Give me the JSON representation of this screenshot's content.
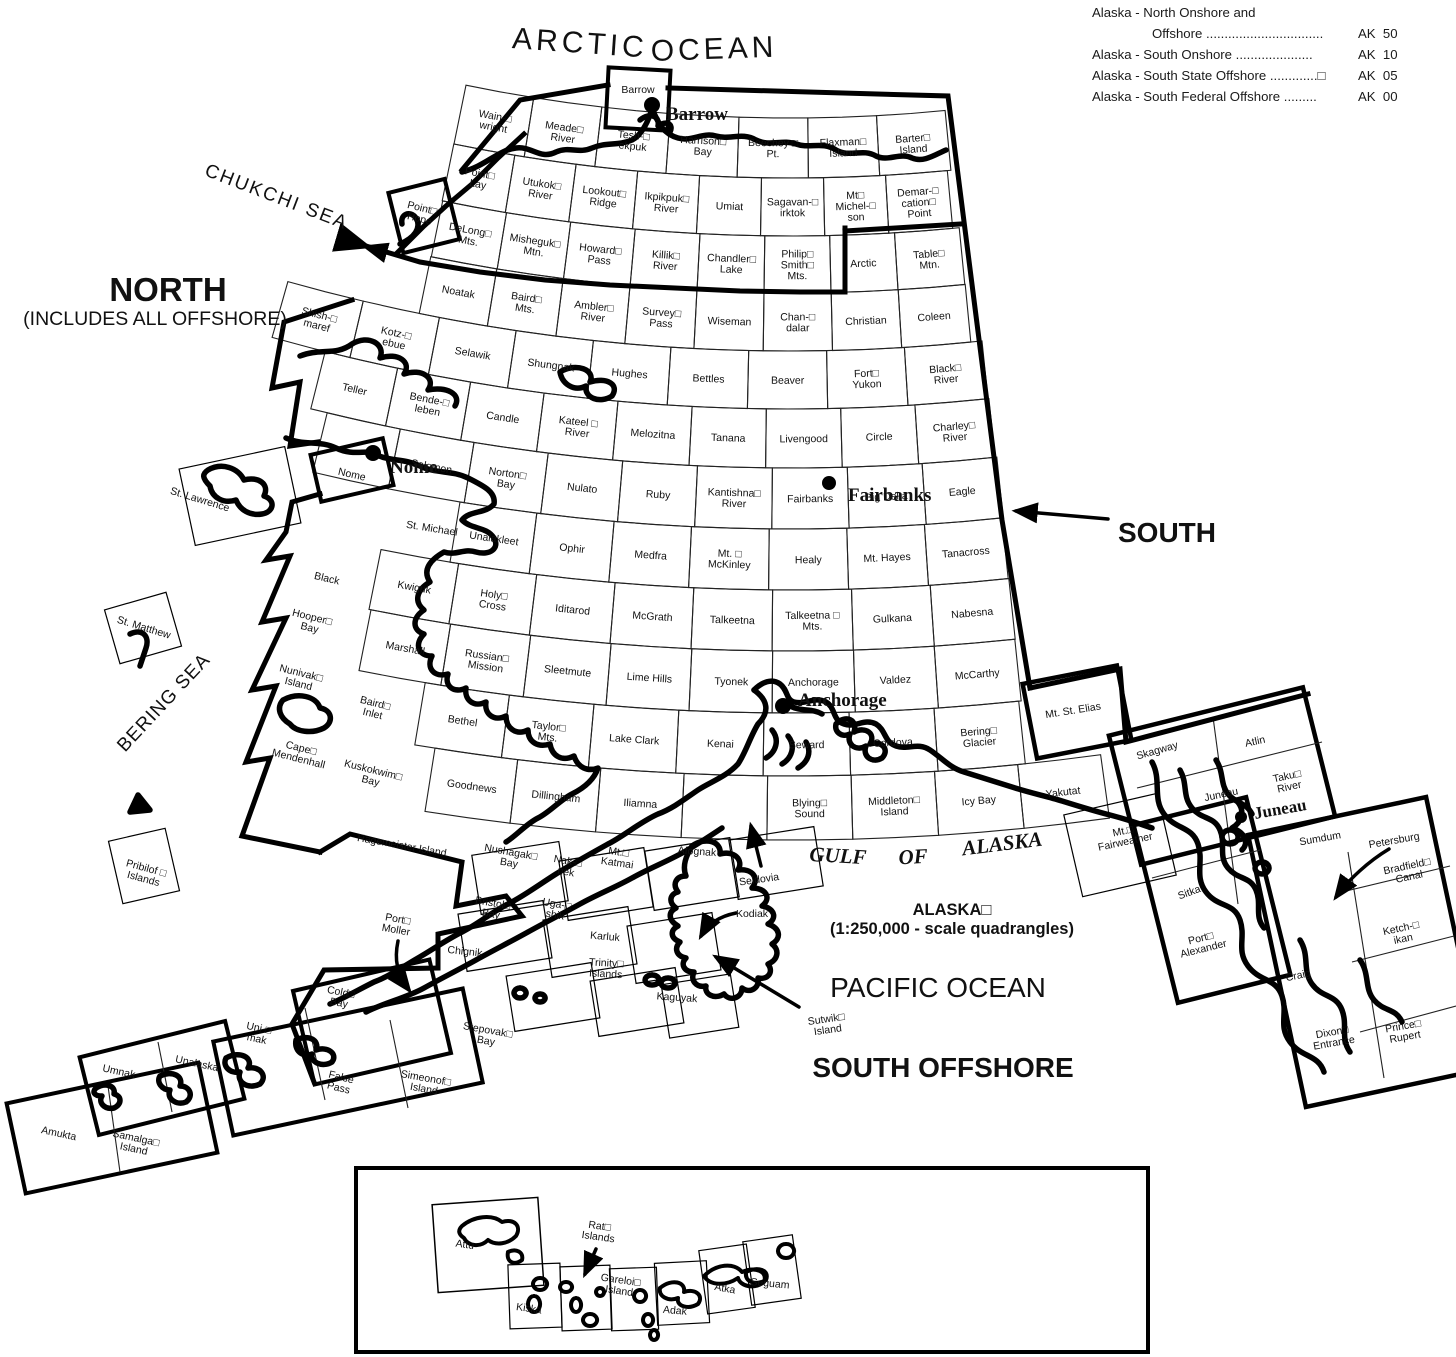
{
  "legend": {
    "items": [
      {
        "line1": "Alaska - North Onshore and",
        "line2": "Offshore ................................",
        "code": "AK  50"
      },
      {
        "line1": "Alaska - South Onshore .....................",
        "code": "AK  10"
      },
      {
        "line1": "Alaska - South State Offshore .............□",
        "code": "AK  05"
      },
      {
        "line1": "Alaska - South Federal Offshore .........",
        "code": "AK  00"
      }
    ]
  },
  "sea_labels": [
    {
      "t": "ARCTIC",
      "x": 580,
      "y": 42,
      "s": 30,
      "sp": 4,
      "r": 4
    },
    {
      "t": "OCEAN",
      "x": 714,
      "y": 48,
      "s": 30,
      "sp": 4,
      "r": -2
    },
    {
      "t": "CHUKCHI SEA",
      "x": 277,
      "y": 196,
      "s": 19,
      "sp": 2,
      "r": 21
    },
    {
      "t": "NORTH",
      "x": 168,
      "y": 289,
      "s": 33,
      "b": 1
    },
    {
      "t": "(INCLUDES ALL OFFSHORE)",
      "x": 155,
      "y": 318,
      "s": 19.5
    },
    {
      "t": "BERING SEA",
      "x": 163,
      "y": 702,
      "s": 19,
      "sp": 1,
      "r": -47
    },
    {
      "t": "SOUTH",
      "x": 1167,
      "y": 532,
      "s": 28,
      "b": 1
    },
    {
      "t": "GULF",
      "x": 838,
      "y": 855,
      "s": 21,
      "b": 1,
      "it": 1,
      "serif": 1,
      "r": 3
    },
    {
      "t": "OF",
      "x": 913,
      "y": 856,
      "s": 21,
      "b": 1,
      "it": 1,
      "serif": 1,
      "r": -3
    },
    {
      "t": "ALASKA",
      "x": 1002,
      "y": 843,
      "s": 21,
      "b": 1,
      "it": 1,
      "serif": 1,
      "r": -7
    },
    {
      "t": "ALASKA□",
      "x": 952,
      "y": 909,
      "s": 16.5,
      "b": 1
    },
    {
      "t": "(1:250,000 - scale quadrangles)",
      "x": 952,
      "y": 928,
      "s": 16.5,
      "b": 1
    },
    {
      "t": "PACIFIC OCEAN",
      "x": 938,
      "y": 987,
      "s": 28
    },
    {
      "t": "SOUTH OFFSHORE",
      "x": 943,
      "y": 1067,
      "s": 28,
      "b": 1
    }
  ],
  "cities": [
    {
      "n": "Barrow",
      "x": 666,
      "y": 113,
      "dx": 652,
      "dy": 105,
      "dr": 8,
      "r": 0,
      "s": 19
    },
    {
      "n": "Nome",
      "x": 390,
      "y": 466,
      "dx": 373,
      "dy": 453,
      "dr": 8,
      "r": 0,
      "s": 19
    },
    {
      "n": "Fairbanks",
      "x": 848,
      "y": 494,
      "dx": 829,
      "dy": 483,
      "dr": 7,
      "r": 0,
      "s": 19
    },
    {
      "n": "Anchorage",
      "x": 798,
      "y": 699,
      "dx": 783,
      "dy": 706,
      "dr": 8,
      "r": 0,
      "s": 19
    },
    {
      "n": "Juneau",
      "x": 1254,
      "y": 813,
      "dx": 1241,
      "dy": 817,
      "dr": 6,
      "r": -10,
      "s": 17
    }
  ],
  "fan_rows": [
    {
      "y0": 118,
      "y1": 178,
      "wx": 460,
      "ex": 948,
      "c": [
        "Wain-□\nwright",
        "Meade□\nRiver",
        "Tesh-□\nekpuk",
        "Harrison□\nBay",
        "Beechey □\nPt.",
        "Flaxman□\nIsland",
        "Barter□\nIsland"
      ]
    },
    {
      "y0": 178,
      "y1": 236,
      "wx": 448,
      "ex": 950,
      "c": [
        "Point□\nLay",
        "Utukok□\nRiver",
        "Lookout□\nRidge",
        "Ikpikpuk□\nRiver",
        "Umiat",
        "Sagavan-□\nirktok",
        "Mt□\nMichel-□\nson",
        "Demar-□\ncation□\nPoint"
      ]
    },
    {
      "y0": 236,
      "y1": 293,
      "wx": 437,
      "ex": 962,
      "c": [
        "DeLong□\nMts.",
        "Misheguk□\nMtn.",
        "Howard□\nPass",
        "Killik□\nRiver",
        "Chandler□\nLake",
        "Philip□\nSmith□\nMts.",
        "Arctic",
        "Table□\nMtn."
      ]
    },
    {
      "y0": 293,
      "y1": 351,
      "wx": 425,
      "ex": 968,
      "c": [
        "Noatak",
        "Baird□\nMts.",
        "Ambler□\nRiver",
        "Survey□\nPass",
        "Wiseman",
        "Chan-□\ndalar",
        "Christian",
        "Coleen"
      ]
    },
    {
      "y0": 351,
      "y1": 409,
      "wx": 280,
      "ex": 985,
      "c": [
        "Shish-□\nmaref",
        "Kotz-□\nebue",
        "Selawik",
        "Shungnak",
        "Hughes",
        "Bettles",
        "Beaver",
        "Fort□\nYukon",
        "Black□\nRiver"
      ]
    },
    {
      "y0": 409,
      "y1": 468,
      "wx": 318,
      "ex": 992,
      "c": [
        "Teller",
        "Bende-□\nleben",
        "Candle",
        "Kateel □\nRiver",
        "Melozitna",
        "Tanana",
        "Livengood",
        "Circle",
        "Charley□\nRiver"
      ]
    },
    {
      "y0": 468,
      "y1": 529,
      "wx": 320,
      "ex": 1000,
      "c": [
        "",
        "Solomon",
        "Norton□\nBay",
        "Nulato",
        "Ruby",
        "Kantishna□\nRiver",
        "Fairbanks",
        "Big Delta",
        "Eagle"
      ]
    },
    {
      "y0": 529,
      "y1": 590,
      "wx": 455,
      "ex": 1005,
      "c": [
        "Unalakleet",
        "Ophir",
        "Medfra",
        "Mt. □\nMcKinley",
        "Healy",
        "Mt. Hayes",
        "Tanacross"
      ]
    },
    {
      "y0": 590,
      "y1": 651,
      "wx": 375,
      "ex": 1012,
      "c": [
        "Kwiguk",
        "Holy□\nCross",
        "Iditarod",
        "McGrath",
        "Talkeetna",
        "Talkeetna □\nMts.",
        "Gulkana",
        "Nabesna"
      ]
    },
    {
      "y0": 651,
      "y1": 713,
      "wx": 365,
      "ex": 1018,
      "c": [
        "Marshall",
        "Russian□\nMission",
        "Sleetmute",
        "Lime Hills",
        "Tyonek",
        "Anchorage",
        "Valdez",
        "McCarthy"
      ]
    },
    {
      "y0": 713,
      "y1": 776,
      "wx": 420,
      "ex": 1022,
      "c": [
        "Bethel",
        "Taylor□\nMts.",
        "Lake Clark",
        "Kenai",
        "Seward",
        "Cordova",
        "Bering□\nGlacier"
      ]
    },
    {
      "y0": 776,
      "y1": 840,
      "wx": 430,
      "ex": 1105,
      "c": [
        "Goodnews",
        "Dillingham",
        "Iliamna",
        "",
        "Blying□\nSound",
        "Middleton□\nIsland",
        "Icy Bay",
        "Yakutat"
      ]
    }
  ],
  "labels": [
    {
      "t": "Point□\nHope",
      "x": 421,
      "y": 213,
      "r": 14
    },
    {
      "t": "Barrow",
      "x": 638,
      "y": 89,
      "r": 0
    },
    {
      "t": "Nome",
      "x": 352,
      "y": 474,
      "r": 13
    },
    {
      "t": "St. Michael",
      "x": 432,
      "y": 528,
      "r": 9
    },
    {
      "t": "Black",
      "x": 327,
      "y": 578,
      "r": 13
    },
    {
      "t": "Hooper□\nBay",
      "x": 311,
      "y": 622,
      "r": 14
    },
    {
      "t": "Nunivak□\nIsland",
      "x": 300,
      "y": 678,
      "r": 14
    },
    {
      "t": "Baird□\nInlet",
      "x": 374,
      "y": 708,
      "r": 14
    },
    {
      "t": "Cape□\nMendenhall",
      "x": 300,
      "y": 753,
      "r": 14
    },
    {
      "t": "Kuskokwim□\nBay",
      "x": 372,
      "y": 775,
      "r": 14
    },
    {
      "t": "Hagemeister Island",
      "x": 402,
      "y": 845,
      "r": 10
    },
    {
      "t": "Nushagak□\nBay",
      "x": 510,
      "y": 857,
      "r": 10
    },
    {
      "t": "Nak-□\nnek",
      "x": 567,
      "y": 866,
      "r": 10
    },
    {
      "t": "Mt.□\nKatmai",
      "x": 618,
      "y": 857,
      "r": 8
    },
    {
      "t": "Afognak",
      "x": 697,
      "y": 851,
      "r": 4
    },
    {
      "t": "Bristol□\nBay",
      "x": 492,
      "y": 908,
      "r": 10
    },
    {
      "t": "Uga-□\nshik",
      "x": 556,
      "y": 909,
      "r": 10
    },
    {
      "t": "Karluk",
      "x": 605,
      "y": 936,
      "r": 5
    },
    {
      "t": "Trinity□\nIslands",
      "x": 606,
      "y": 968,
      "r": 3
    },
    {
      "t": "Kaguyak",
      "x": 677,
      "y": 997,
      "r": 4
    },
    {
      "t": "Seldovia",
      "x": 759,
      "y": 879,
      "r": -8
    },
    {
      "t": "Kodiak",
      "x": 752,
      "y": 913,
      "r": 0
    },
    {
      "t": "Port□\nMoller",
      "x": 397,
      "y": 924,
      "r": 10
    },
    {
      "t": "Chignik",
      "x": 465,
      "y": 951,
      "r": 6
    },
    {
      "t": "Stepovak□\nBay",
      "x": 487,
      "y": 1035,
      "r": 10
    },
    {
      "t": "Sutwik□\nIsland",
      "x": 827,
      "y": 1024,
      "r": -8
    },
    {
      "t": "Cold□\nBay",
      "x": 340,
      "y": 997,
      "r": 11
    },
    {
      "t": "Uni-□\nmak",
      "x": 258,
      "y": 1033,
      "r": 12
    },
    {
      "t": "False\nPass",
      "x": 340,
      "y": 1082,
      "r": 14
    },
    {
      "t": "Simeonof□\nIsland",
      "x": 425,
      "y": 1083,
      "r": 10
    },
    {
      "t": "Umnak",
      "x": 119,
      "y": 1071,
      "r": 12
    },
    {
      "t": "Unalaska",
      "x": 197,
      "y": 1063,
      "r": 12
    },
    {
      "t": "Amukta",
      "x": 59,
      "y": 1133,
      "r": 12
    },
    {
      "t": "Samalga□\nIsland",
      "x": 135,
      "y": 1143,
      "r": 12
    },
    {
      "t": "St. Lawrence",
      "x": 200,
      "y": 499,
      "r": 17
    },
    {
      "t": "St. Matthew",
      "x": 144,
      "y": 627,
      "r": 17
    },
    {
      "t": "Pribilof □\nIslands",
      "x": 145,
      "y": 873,
      "r": 15
    },
    {
      "t": "Mt. St. Elias",
      "x": 1073,
      "y": 710,
      "r": -9
    },
    {
      "t": "Mt.□\nFairweather",
      "x": 1124,
      "y": 836,
      "r": -12
    },
    {
      "t": "Skagway",
      "x": 1157,
      "y": 750,
      "r": -16
    },
    {
      "t": "Atlin",
      "x": 1255,
      "y": 741,
      "r": -12
    },
    {
      "t": "Juneau",
      "x": 1221,
      "y": 794,
      "r": -12
    },
    {
      "t": "Taku□\nRiver",
      "x": 1288,
      "y": 781,
      "r": -12
    },
    {
      "t": "Sumdum",
      "x": 1320,
      "y": 838,
      "r": -10
    },
    {
      "t": "Sitka",
      "x": 1189,
      "y": 892,
      "r": -20
    },
    {
      "t": "Port□\nAlexander",
      "x": 1202,
      "y": 943,
      "r": -14
    },
    {
      "t": "Petersburg",
      "x": 1394,
      "y": 840,
      "r": -10
    },
    {
      "t": "Bradfield□\nCanal",
      "x": 1408,
      "y": 871,
      "r": -12
    },
    {
      "t": "Ketch-□\nikan",
      "x": 1402,
      "y": 933,
      "r": -12
    },
    {
      "t": "Craig",
      "x": 1298,
      "y": 975,
      "r": -12
    },
    {
      "t": "Dixon□\nEntrance",
      "x": 1333,
      "y": 1037,
      "r": -10
    },
    {
      "t": "Prince□\nRupert",
      "x": 1404,
      "y": 1031,
      "r": -10
    },
    {
      "t": "Attu",
      "x": 465,
      "y": 1244,
      "r": 8
    },
    {
      "t": "Rat□\nIslands",
      "x": 599,
      "y": 1231,
      "r": 8
    },
    {
      "t": "Kiska",
      "x": 529,
      "y": 1308,
      "r": 8
    },
    {
      "t": "Gareloi□\nIsland",
      "x": 620,
      "y": 1285,
      "r": 8
    },
    {
      "t": "Adak",
      "x": 675,
      "y": 1310,
      "r": 5
    },
    {
      "t": "Atka",
      "x": 725,
      "y": 1288,
      "r": 10
    },
    {
      "t": "Seguam",
      "x": 770,
      "y": 1283,
      "r": 5
    }
  ],
  "boxes": [
    {
      "x": 638,
      "y": 99,
      "w": 62,
      "h": 60,
      "r": 3,
      "k": 4
    },
    {
      "x": 424,
      "y": 216,
      "w": 58,
      "h": 62,
      "r": -14,
      "k": 4
    },
    {
      "x": 352,
      "y": 470,
      "w": 74,
      "h": 48,
      "r": -13,
      "k": 4
    },
    {
      "x": 240,
      "y": 496,
      "w": 108,
      "h": 78,
      "r": -12,
      "k": 1.2
    },
    {
      "x": 143,
      "y": 628,
      "w": 64,
      "h": 56,
      "r": -16,
      "k": 1.2
    },
    {
      "x": 144,
      "y": 866,
      "w": 58,
      "h": 64,
      "r": -13,
      "k": 1.2
    },
    {
      "x": 1077,
      "y": 712,
      "w": 96,
      "h": 76,
      "r": -11,
      "k": 4.5
    },
    {
      "x": 1120,
      "y": 845,
      "w": 96,
      "h": 84,
      "r": -13,
      "k": 1.2
    },
    {
      "x": 1222,
      "y": 776,
      "w": 200,
      "h": 133,
      "r": -14,
      "k": 4.5
    },
    {
      "x": 1212,
      "y": 900,
      "w": 116,
      "h": 183,
      "r": -14,
      "k": 4.5
    },
    {
      "x": 1366,
      "y": 952,
      "w": 182,
      "h": 278,
      "r": -12,
      "k": 4.5
    },
    {
      "x": 372,
      "y": 1022,
      "w": 140,
      "h": 96,
      "r": -13,
      "k": 4
    },
    {
      "x": 348,
      "y": 1062,
      "w": 255,
      "h": 96,
      "r": -12,
      "k": 4
    },
    {
      "x": 162,
      "y": 1078,
      "w": 150,
      "h": 80,
      "r": -14,
      "k": 4
    },
    {
      "x": 112,
      "y": 1128,
      "w": 196,
      "h": 92,
      "r": -12,
      "k": 4
    },
    {
      "x": 520,
      "y": 878,
      "w": 88,
      "h": 60,
      "r": -9,
      "k": 1.2
    },
    {
      "x": 606,
      "y": 884,
      "w": 86,
      "h": 60,
      "r": -9,
      "k": 1.2
    },
    {
      "x": 692,
      "y": 874,
      "w": 86,
      "h": 60,
      "r": -9,
      "k": 1.2
    },
    {
      "x": 776,
      "y": 863,
      "w": 86,
      "h": 60,
      "r": -9,
      "k": 1.2
    },
    {
      "x": 505,
      "y": 936,
      "w": 86,
      "h": 58,
      "r": -9,
      "k": 1.2
    },
    {
      "x": 590,
      "y": 942,
      "w": 86,
      "h": 58,
      "r": -9,
      "k": 1.2
    },
    {
      "x": 674,
      "y": 948,
      "w": 86,
      "h": 58,
      "r": -9,
      "k": 1.2
    },
    {
      "x": 553,
      "y": 997,
      "w": 86,
      "h": 56,
      "r": -9,
      "k": 1.2
    },
    {
      "x": 637,
      "y": 1002,
      "w": 86,
      "h": 56,
      "r": -9,
      "k": 1.2
    },
    {
      "x": 700,
      "y": 1006,
      "w": 70,
      "h": 54,
      "r": -9,
      "k": 1.2
    },
    {
      "x": 488,
      "y": 1245,
      "w": 106,
      "h": 88,
      "r": -4,
      "k": 1.5
    },
    {
      "x": 535,
      "y": 1296,
      "w": 52,
      "h": 64,
      "r": -2,
      "k": 1.2
    },
    {
      "x": 586,
      "y": 1298,
      "w": 50,
      "h": 64,
      "r": -2,
      "k": 1.2
    },
    {
      "x": 634,
      "y": 1299,
      "w": 47,
      "h": 62,
      "r": -2,
      "k": 1.2
    },
    {
      "x": 682,
      "y": 1293,
      "w": 52,
      "h": 62,
      "r": -3,
      "k": 1.2
    },
    {
      "x": 727,
      "y": 1279,
      "w": 48,
      "h": 64,
      "r": -8,
      "k": 1.2
    },
    {
      "x": 772,
      "y": 1270,
      "w": 50,
      "h": 64,
      "r": -8,
      "k": 1.2
    }
  ]
}
